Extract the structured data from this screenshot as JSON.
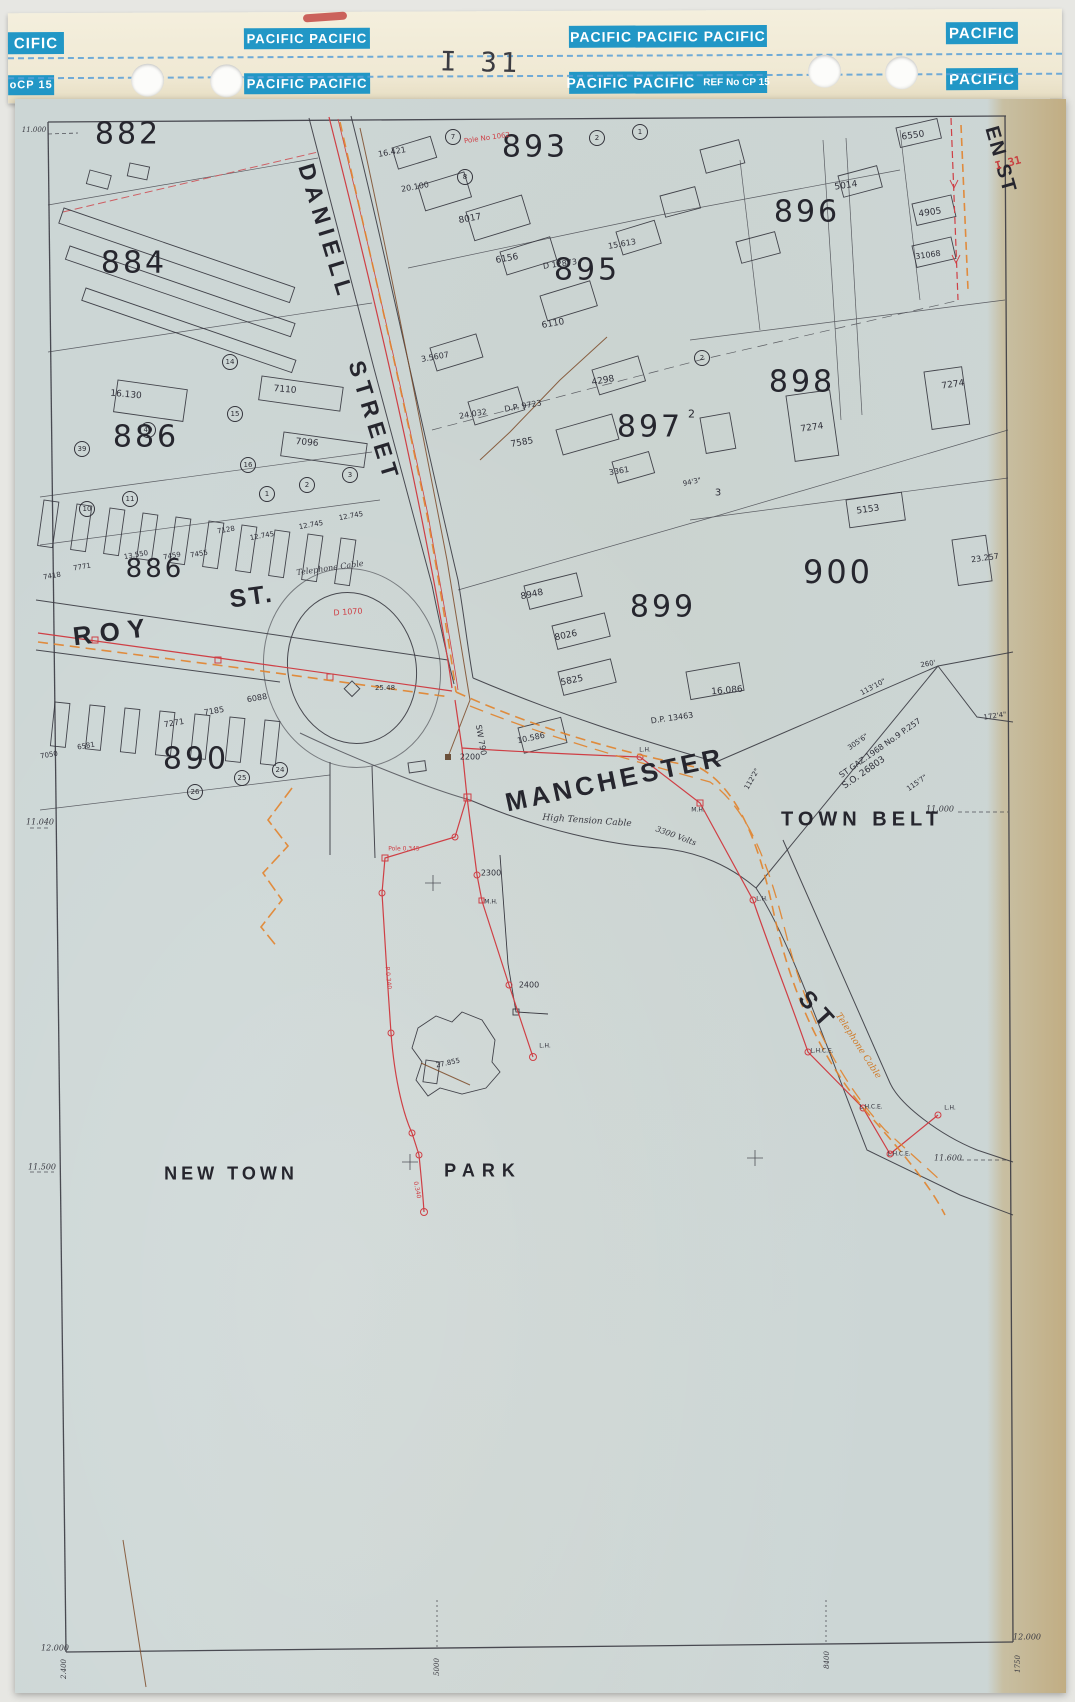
{
  "header": {
    "handwritten": "I 31",
    "blocks": [
      {
        "t": "CIFIC",
        "x": 0,
        "y": 19,
        "w": 56,
        "h": 22,
        "fs": 15
      },
      {
        "t": "PACIFIC  PACIFIC",
        "x": 236,
        "y": 16,
        "w": 126,
        "h": 21,
        "fs": 13
      },
      {
        "t": "PACIFIC  PACIFIC  PACIFIC",
        "x": 561,
        "y": 15,
        "w": 198,
        "h": 22,
        "fs": 14
      },
      {
        "t": "PACIFIC",
        "x": 938,
        "y": 13,
        "w": 72,
        "h": 22,
        "fs": 15
      },
      {
        "t": "oCP 15",
        "x": 0,
        "y": 62,
        "w": 46,
        "h": 20,
        "fs": 11
      },
      {
        "t": "PACIFIC  PACIFIC",
        "x": 236,
        "y": 61,
        "w": 126,
        "h": 21,
        "fs": 13
      },
      {
        "t": "PACIFIC  PACIFIC",
        "x": 561,
        "y": 61,
        "w": 198,
        "h": 22,
        "fs": 14,
        "sfx": "REF No CP 15"
      },
      {
        "t": "PACIFIC",
        "x": 938,
        "y": 59,
        "w": 72,
        "h": 22,
        "fs": 15
      }
    ],
    "dash_lines_y": [
      44,
      64
    ],
    "holes": [
      {
        "x": 123,
        "y": 51
      },
      {
        "x": 202,
        "y": 52
      },
      {
        "x": 800,
        "y": 45
      },
      {
        "x": 877,
        "y": 47
      }
    ]
  },
  "colors": {
    "pacific_blue": "#2297c6",
    "binder_cream": "#f1ebd8",
    "sheet_blue": "#ccd6d5",
    "edge_tan": "#c1ad83",
    "cable_red": "#cf3f45",
    "cable_orange": "#e2832c",
    "line_black": "#3a3a42",
    "dash_blue": "#5aa0d8",
    "mark_red": "#c34944"
  },
  "map": {
    "labels": [
      {
        "t": "882",
        "x": 128,
        "y": 134,
        "s": 30,
        "k": "b"
      },
      {
        "t": "884",
        "x": 134,
        "y": 263,
        "s": 30,
        "k": "b"
      },
      {
        "t": "893",
        "x": 535,
        "y": 147,
        "s": 30,
        "k": "b"
      },
      {
        "t": "895",
        "x": 587,
        "y": 270,
        "s": 30,
        "k": "b"
      },
      {
        "t": "896",
        "x": 807,
        "y": 212,
        "s": 30,
        "k": "b"
      },
      {
        "t": "886",
        "x": 146,
        "y": 437,
        "s": 30,
        "k": "b"
      },
      {
        "t": "886",
        "x": 155,
        "y": 569,
        "s": 26,
        "k": "b"
      },
      {
        "t": "897",
        "x": 650,
        "y": 427,
        "s": 30,
        "k": "b"
      },
      {
        "t": "2",
        "x": 693,
        "y": 414,
        "s": 11,
        "k": "b"
      },
      {
        "t": "898",
        "x": 802,
        "y": 382,
        "s": 30,
        "k": "b"
      },
      {
        "t": "899",
        "x": 663,
        "y": 607,
        "s": 30,
        "k": "b"
      },
      {
        "t": "900",
        "x": 838,
        "y": 572,
        "s": 32,
        "k": "b"
      },
      {
        "t": "890",
        "x": 196,
        "y": 759,
        "s": 30,
        "k": "b"
      },
      {
        "t": "DANIELL",
        "x": 326,
        "y": 232,
        "s": 23,
        "r": 73,
        "sp": 6,
        "k": "s"
      },
      {
        "t": "STREET",
        "x": 374,
        "y": 422,
        "s": 23,
        "r": 73,
        "sp": 6,
        "k": "s"
      },
      {
        "t": "ROY",
        "x": 113,
        "y": 632,
        "s": 26,
        "r": -7,
        "sp": 8,
        "k": "s"
      },
      {
        "t": "ST.",
        "x": 252,
        "y": 597,
        "s": 25,
        "r": -8,
        "sp": 3,
        "k": "s"
      },
      {
        "t": "MANCHESTER",
        "x": 615,
        "y": 780,
        "s": 26,
        "r": -12,
        "sp": 4,
        "k": "s"
      },
      {
        "t": "ST",
        "x": 818,
        "y": 1012,
        "s": 24,
        "r": 48,
        "sp": 8,
        "k": "s"
      },
      {
        "t": "EN ST",
        "x": 1000,
        "y": 160,
        "s": 20,
        "r": 74,
        "sp": 2,
        "k": "s"
      },
      {
        "t": "TOWN  BELT",
        "x": 862,
        "y": 820,
        "s": 20,
        "sp": 5,
        "k": "s"
      },
      {
        "t": "NEW TOWN",
        "x": 231,
        "y": 1174,
        "s": 18,
        "sp": 4,
        "k": "s"
      },
      {
        "t": "PARK",
        "x": 483,
        "y": 1171,
        "s": 18,
        "sp": 7,
        "k": "s"
      },
      {
        "t": "16.421",
        "x": 392,
        "y": 152,
        "s": 8,
        "r": -10,
        "k": "m"
      },
      {
        "t": "20.100",
        "x": 415,
        "y": 187,
        "s": 8,
        "r": -10,
        "k": "m"
      },
      {
        "t": "8017",
        "x": 470,
        "y": 219,
        "s": 9,
        "r": -10,
        "k": "m"
      },
      {
        "t": "6156",
        "x": 507,
        "y": 259,
        "s": 9,
        "r": -10,
        "k": "m"
      },
      {
        "t": "6110",
        "x": 553,
        "y": 324,
        "s": 9,
        "r": -10,
        "k": "m"
      },
      {
        "t": "3.5607",
        "x": 435,
        "y": 357,
        "s": 8,
        "r": -10,
        "k": "m"
      },
      {
        "t": "24.032",
        "x": 473,
        "y": 414,
        "s": 8,
        "r": -10,
        "k": "m"
      },
      {
        "t": "4298",
        "x": 603,
        "y": 381,
        "s": 9,
        "r": -10,
        "k": "m"
      },
      {
        "t": "7585",
        "x": 522,
        "y": 443,
        "s": 9,
        "r": -10,
        "k": "m"
      },
      {
        "t": "3361",
        "x": 619,
        "y": 471,
        "s": 8,
        "r": -10,
        "k": "m"
      },
      {
        "t": "8948",
        "x": 532,
        "y": 595,
        "s": 9,
        "r": -12,
        "k": "m"
      },
      {
        "t": "8026",
        "x": 566,
        "y": 636,
        "s": 9,
        "r": -12,
        "k": "m"
      },
      {
        "t": "5825",
        "x": 572,
        "y": 681,
        "s": 9,
        "r": -12,
        "k": "m"
      },
      {
        "t": "10.586",
        "x": 531,
        "y": 738,
        "s": 8,
        "r": -12,
        "k": "m"
      },
      {
        "t": "16.086",
        "x": 727,
        "y": 691,
        "s": 9,
        "r": -5,
        "k": "m"
      },
      {
        "t": "16.130",
        "x": 126,
        "y": 395,
        "s": 9,
        "r": 5,
        "k": "m"
      },
      {
        "t": "7110",
        "x": 285,
        "y": 390,
        "s": 9,
        "r": 5,
        "k": "m"
      },
      {
        "t": "7096",
        "x": 307,
        "y": 443,
        "s": 9,
        "r": 5,
        "k": "m"
      },
      {
        "t": "12.745",
        "x": 262,
        "y": 536,
        "s": 7,
        "r": -10,
        "k": "m"
      },
      {
        "t": "12.745",
        "x": 311,
        "y": 525,
        "s": 7,
        "r": -10,
        "k": "m"
      },
      {
        "t": "12.745",
        "x": 351,
        "y": 516,
        "s": 7,
        "r": -10,
        "k": "m"
      },
      {
        "t": "7128",
        "x": 226,
        "y": 530,
        "s": 7,
        "r": -10,
        "k": "m"
      },
      {
        "t": "13.550",
        "x": 136,
        "y": 555,
        "s": 7,
        "r": -10,
        "k": "m"
      },
      {
        "t": "7459",
        "x": 172,
        "y": 556,
        "s": 7,
        "r": -10,
        "k": "m"
      },
      {
        "t": "7455",
        "x": 199,
        "y": 554,
        "s": 7,
        "r": -10,
        "k": "m"
      },
      {
        "t": "7771",
        "x": 82,
        "y": 567,
        "s": 7,
        "r": -10,
        "k": "m"
      },
      {
        "t": "7418",
        "x": 52,
        "y": 576,
        "s": 7,
        "r": -10,
        "k": "m"
      },
      {
        "t": "6088",
        "x": 257,
        "y": 698,
        "s": 8,
        "r": -10,
        "k": "m"
      },
      {
        "t": "7185",
        "x": 214,
        "y": 711,
        "s": 8,
        "r": -10,
        "k": "m"
      },
      {
        "t": "7271",
        "x": 174,
        "y": 723,
        "s": 8,
        "r": -10,
        "k": "m"
      },
      {
        "t": "7050",
        "x": 49,
        "y": 755,
        "s": 7,
        "r": -10,
        "k": "m"
      },
      {
        "t": "6581",
        "x": 86,
        "y": 746,
        "s": 7,
        "r": -10,
        "k": "m"
      },
      {
        "t": "6550",
        "x": 913,
        "y": 136,
        "s": 9,
        "r": -8,
        "k": "m"
      },
      {
        "t": "5014",
        "x": 846,
        "y": 186,
        "s": 9,
        "r": -8,
        "k": "m"
      },
      {
        "t": "4905",
        "x": 930,
        "y": 213,
        "s": 9,
        "r": -8,
        "k": "m"
      },
      {
        "t": "31068",
        "x": 928,
        "y": 255,
        "s": 8,
        "r": -8,
        "k": "m"
      },
      {
        "t": "15.613",
        "x": 622,
        "y": 244,
        "s": 8,
        "r": -10,
        "k": "m"
      },
      {
        "t": "7274",
        "x": 812,
        "y": 428,
        "s": 9,
        "r": -8,
        "k": "m"
      },
      {
        "t": "7274",
        "x": 953,
        "y": 385,
        "s": 9,
        "r": -8,
        "k": "m"
      },
      {
        "t": "5153",
        "x": 868,
        "y": 510,
        "s": 9,
        "r": -8,
        "k": "m"
      },
      {
        "t": "23.257",
        "x": 985,
        "y": 558,
        "s": 8,
        "r": -8,
        "k": "m"
      },
      {
        "t": "27.855",
        "x": 448,
        "y": 1063,
        "s": 7,
        "r": -12,
        "k": "m"
      },
      {
        "t": "25.48",
        "x": 385,
        "y": 688,
        "s": 7,
        "k": "m"
      },
      {
        "t": "D.P. 9723",
        "x": 523,
        "y": 406,
        "s": 8,
        "r": -10,
        "k": "m"
      },
      {
        "t": "D.P. 13463",
        "x": 672,
        "y": 718,
        "s": 8,
        "r": -8,
        "k": "m"
      },
      {
        "t": "D 12873",
        "x": 560,
        "y": 264,
        "s": 8,
        "r": -8,
        "k": "m"
      },
      {
        "t": "3",
        "x": 718,
        "y": 493,
        "s": 10,
        "k": "m"
      },
      {
        "t": "94'3\"",
        "x": 692,
        "y": 482,
        "s": 7,
        "r": -12,
        "k": "m"
      },
      {
        "t": "260'",
        "x": 928,
        "y": 664,
        "s": 7,
        "r": -10,
        "k": "m"
      },
      {
        "t": "113'10\"",
        "x": 873,
        "y": 687,
        "s": 7,
        "r": -28,
        "k": "m"
      },
      {
        "t": "305'6\"",
        "x": 858,
        "y": 742,
        "s": 7,
        "r": -35,
        "k": "m"
      },
      {
        "t": "115'7\"",
        "x": 917,
        "y": 783,
        "s": 7,
        "r": -35,
        "k": "m"
      },
      {
        "t": "112'2\"",
        "x": 752,
        "y": 779,
        "s": 7,
        "r": -60,
        "k": "m"
      },
      {
        "t": "172'4\"",
        "x": 995,
        "y": 716,
        "s": 7,
        "r": -8,
        "k": "m"
      },
      {
        "t": "ST  GAZ.1968  No.9  P.257",
        "x": 880,
        "y": 748,
        "s": 8,
        "r": -35,
        "k": "m"
      },
      {
        "t": "S.O.  26803",
        "x": 864,
        "y": 773,
        "s": 9,
        "r": -35,
        "k": "m"
      },
      {
        "t": "High  Tension  Cable",
        "x": 587,
        "y": 821,
        "s": 9,
        "r": 4,
        "i": 1
      },
      {
        "t": "3300  Volts",
        "x": 676,
        "y": 836,
        "s": 8,
        "r": 20,
        "i": 1
      },
      {
        "t": "Telephone  Cable",
        "x": 330,
        "y": 568,
        "s": 8,
        "r": -8,
        "i": 1
      },
      {
        "t": "Telephone  Cable",
        "x": 858,
        "y": 1046,
        "s": 9,
        "r": 57,
        "i": 1,
        "c": "#d07a28"
      },
      {
        "t": "SW 790",
        "x": 481,
        "y": 740,
        "s": 8,
        "r": 80,
        "k": "m"
      },
      {
        "t": "2200",
        "x": 470,
        "y": 757,
        "s": 8,
        "k": "m"
      },
      {
        "t": "2300",
        "x": 491,
        "y": 873,
        "s": 8,
        "k": "m"
      },
      {
        "t": "2400",
        "x": 529,
        "y": 985,
        "s": 8,
        "k": "m"
      },
      {
        "t": "M.H.",
        "x": 491,
        "y": 902,
        "s": 6,
        "k": "m"
      },
      {
        "t": "M.H.",
        "x": 698,
        "y": 810,
        "s": 6,
        "k": "m"
      },
      {
        "t": "L.H.",
        "x": 545,
        "y": 1046,
        "s": 6,
        "k": "m"
      },
      {
        "t": "L.H.",
        "x": 762,
        "y": 899,
        "s": 6,
        "k": "m"
      },
      {
        "t": "L.H.",
        "x": 645,
        "y": 750,
        "s": 6,
        "k": "m"
      },
      {
        "t": "L.H.C.E.",
        "x": 822,
        "y": 1051,
        "s": 6,
        "k": "m"
      },
      {
        "t": "L.H.C.E.",
        "x": 871,
        "y": 1107,
        "s": 6,
        "k": "m"
      },
      {
        "t": "L.H.C.E.",
        "x": 899,
        "y": 1154,
        "s": 6,
        "k": "m"
      },
      {
        "t": "L.H.",
        "x": 950,
        "y": 1108,
        "s": 6,
        "k": "m"
      },
      {
        "t": "11.040",
        "x": 40,
        "y": 822,
        "s": 8,
        "i": 1
      },
      {
        "t": "11.500",
        "x": 42,
        "y": 1167,
        "s": 8,
        "i": 1
      },
      {
        "t": "11.000",
        "x": 940,
        "y": 809,
        "s": 8,
        "i": 1
      },
      {
        "t": "11.600",
        "x": 948,
        "y": 1158,
        "s": 8,
        "i": 1
      },
      {
        "t": "11.000",
        "x": 34,
        "y": 130,
        "s": 7,
        "i": 1
      },
      {
        "t": "12.000",
        "x": 55,
        "y": 1648,
        "s": 8,
        "i": 1
      },
      {
        "t": "12.000",
        "x": 1027,
        "y": 1637,
        "s": 8,
        "i": 1
      },
      {
        "t": "2.400",
        "x": 64,
        "y": 1669,
        "s": 7,
        "r": -90,
        "i": 1
      },
      {
        "t": "5000",
        "x": 437,
        "y": 1667,
        "s": 7,
        "r": -90,
        "i": 1
      },
      {
        "t": "8400",
        "x": 827,
        "y": 1660,
        "s": 7,
        "r": -90,
        "i": 1
      },
      {
        "t": "1750",
        "x": 1018,
        "y": 1664,
        "s": 7,
        "r": -90,
        "i": 1
      },
      {
        "t": "D 1070",
        "x": 348,
        "y": 612,
        "s": 8,
        "r": -4,
        "c": "#cf3f45",
        "k": "m"
      },
      {
        "t": "Pole No 1062",
        "x": 487,
        "y": 138,
        "s": 7,
        "r": -8,
        "c": "#cf3f45",
        "k": "m"
      },
      {
        "t": "Pole 0.345",
        "x": 404,
        "y": 849,
        "s": 6,
        "c": "#cf3f45",
        "k": "m"
      },
      {
        "t": "P 0.340",
        "x": 388,
        "y": 978,
        "s": 6,
        "r": 84,
        "c": "#cf3f45",
        "k": "m"
      },
      {
        "t": "0.340",
        "x": 417,
        "y": 1190,
        "s": 6,
        "r": 78,
        "c": "#cf3f45",
        "k": "m"
      },
      {
        "t": "I 31",
        "x": 1008,
        "y": 163,
        "s": 11,
        "r": -14,
        "c": "#c84040",
        "k": "hand"
      }
    ],
    "lot_circles": [
      {
        "n": "7",
        "x": 453,
        "y": 137
      },
      {
        "n": "8",
        "x": 465,
        "y": 177
      },
      {
        "n": "2",
        "x": 597,
        "y": 138
      },
      {
        "n": "1",
        "x": 640,
        "y": 132
      },
      {
        "n": "14",
        "x": 230,
        "y": 362
      },
      {
        "n": "15",
        "x": 235,
        "y": 414
      },
      {
        "n": "40",
        "x": 148,
        "y": 430
      },
      {
        "n": "39",
        "x": 82,
        "y": 449
      },
      {
        "n": "16",
        "x": 248,
        "y": 465
      },
      {
        "n": "11",
        "x": 130,
        "y": 499
      },
      {
        "n": "10",
        "x": 87,
        "y": 509
      },
      {
        "n": "1",
        "x": 267,
        "y": 494
      },
      {
        "n": "2",
        "x": 307,
        "y": 485
      },
      {
        "n": "3",
        "x": 350,
        "y": 475
      },
      {
        "n": "2",
        "x": 702,
        "y": 358
      },
      {
        "n": "26",
        "x": 195,
        "y": 792
      },
      {
        "n": "25",
        "x": 242,
        "y": 778
      },
      {
        "n": "24",
        "x": 280,
        "y": 770
      }
    ]
  }
}
